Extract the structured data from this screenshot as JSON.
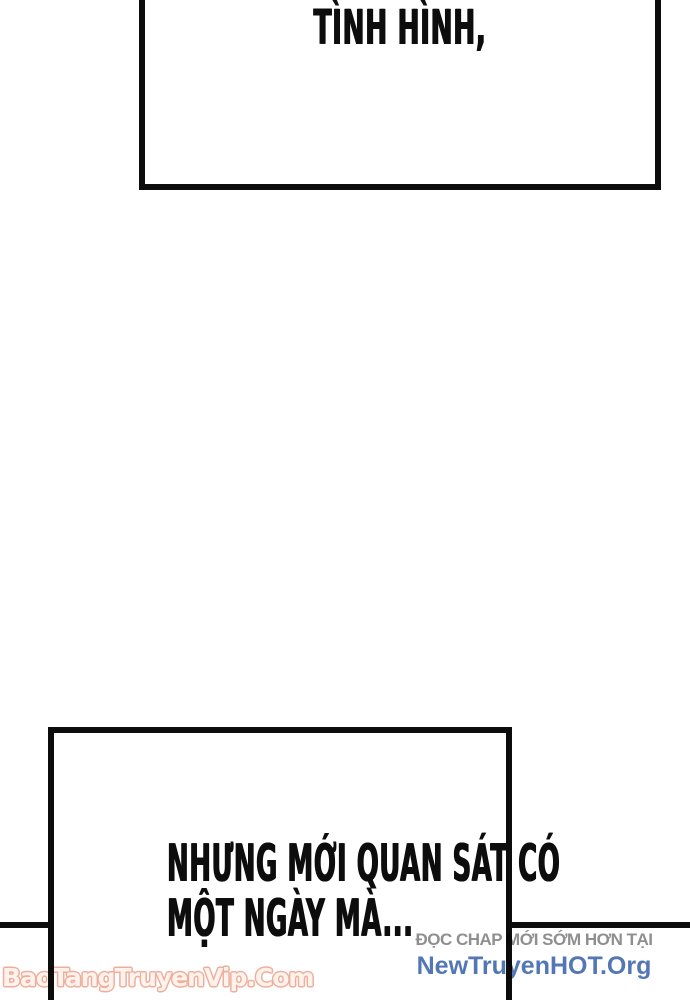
{
  "page": {
    "background": "#ffffff",
    "ink_color": "#0d0d0d"
  },
  "balloons": {
    "top": {
      "text": "TÌNH HÌNH,"
    },
    "bottom": {
      "line1": "NHƯNG MỚI QUAN SÁT CÓ",
      "line2": "MỘT NGÀY MÀ..."
    }
  },
  "watermarks": {
    "bottom_left": {
      "text": "BaoTangTruyenVip.Com",
      "fill_color": "#fdf2ec",
      "outline_color": "#eeae9c"
    },
    "bottom_right": {
      "tagline": "ĐỌC CHAP MỚI SỚM HƠN TẠI",
      "site": "NewTruyenHOT.Org",
      "tagline_color": "#8f8f8f",
      "site_color": "#5377b5"
    }
  }
}
